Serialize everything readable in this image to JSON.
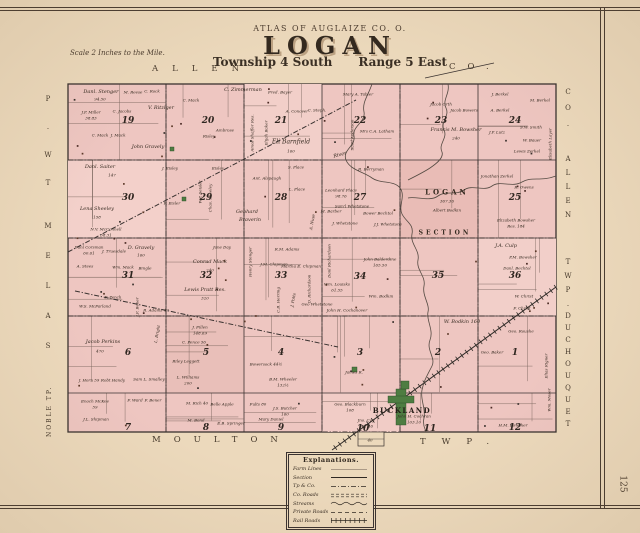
{
  "page": {
    "number": "125"
  },
  "colors": {
    "paper": "#ecd9bc",
    "map_pink": "#eec6c1",
    "village_green": "#4e7d42",
    "ink": "#3a3230"
  },
  "header": {
    "atlas_line": "ATLAS OF AUGLAIZE CO. O.",
    "title": "LOGAN",
    "township": "Township 4 South",
    "range": "Range 5 East",
    "scale_note": "Scale 2 Inches to the Mile."
  },
  "borders": {
    "top_name": "ALLEN",
    "top_suffix": "CO.",
    "right_co": "CO.",
    "right_county": "ALLEN",
    "right_twp": "TWP.",
    "right_township": "DUCHOUQUET",
    "left_top_display": "P.WT",
    "left_mid_display": "MELAS",
    "noble": "NOBLE TP.",
    "bottom_name": "MOULTON",
    "bottom_suffix": "TWP."
  },
  "village": {
    "name": "BUCKLAND"
  },
  "legend": {
    "title": "Explanations.",
    "rows": [
      {
        "label": "Farm Lines",
        "style": "thin"
      },
      {
        "label": "Section",
        "style": "solid"
      },
      {
        "label": "Tp & Co.",
        "style": "dashdot"
      },
      {
        "label": "Co. Roads",
        "style": "double"
      },
      {
        "label": "Streams",
        "style": "wavy"
      },
      {
        "label": "Private Roads",
        "style": "dashed"
      },
      {
        "label": "Rail Roads",
        "style": "rail"
      }
    ]
  },
  "section_numbers": [
    {
      "n": "19",
      "x": 128,
      "y": 121
    },
    {
      "n": "20",
      "x": 208,
      "y": 121
    },
    {
      "n": "21",
      "x": 281,
      "y": 121
    },
    {
      "n": "22",
      "x": 360,
      "y": 121
    },
    {
      "n": "23",
      "x": 441,
      "y": 121
    },
    {
      "n": "24",
      "x": 515,
      "y": 121
    },
    {
      "n": "30",
      "x": 128,
      "y": 198
    },
    {
      "n": "29",
      "x": 206,
      "y": 198
    },
    {
      "n": "28",
      "x": 281,
      "y": 198
    },
    {
      "n": "27",
      "x": 360,
      "y": 198
    },
    {
      "n": "25",
      "x": 515,
      "y": 198
    },
    {
      "n": "31",
      "x": 128,
      "y": 276
    },
    {
      "n": "32",
      "x": 206,
      "y": 276
    },
    {
      "n": "33",
      "x": 281,
      "y": 276
    },
    {
      "n": "34",
      "x": 360,
      "y": 277
    },
    {
      "n": "35",
      "x": 438,
      "y": 276
    },
    {
      "n": "36",
      "x": 515,
      "y": 276
    },
    {
      "n": "6",
      "x": 128,
      "y": 353
    },
    {
      "n": "5",
      "x": 206,
      "y": 353
    },
    {
      "n": "4",
      "x": 281,
      "y": 353
    },
    {
      "n": "3",
      "x": 360,
      "y": 353
    },
    {
      "n": "2",
      "x": 438,
      "y": 353
    },
    {
      "n": "1",
      "x": 515,
      "y": 353
    },
    {
      "n": "7",
      "x": 128,
      "y": 428
    },
    {
      "n": "8",
      "x": 206,
      "y": 428
    },
    {
      "n": "9",
      "x": 281,
      "y": 428
    },
    {
      "n": "10",
      "x": 363,
      "y": 429
    },
    {
      "n": "11",
      "x": 430,
      "y": 429
    },
    {
      "n": "12",
      "x": 515,
      "y": 428
    }
  ],
  "map_labels": [
    {
      "t": "Danl. Stenger",
      "x": 101,
      "y": 92
    },
    {
      "t": "94.50",
      "x": 100,
      "y": 99,
      "s": 4
    },
    {
      "t": "M. Reese",
      "x": 133,
      "y": 92,
      "s": 4
    },
    {
      "t": "C. Rock",
      "x": 152,
      "y": 91,
      "s": 4
    },
    {
      "t": "C. Zimmerman",
      "x": 243,
      "y": 90
    },
    {
      "t": "Fred. Bayer",
      "x": 280,
      "y": 92,
      "s": 4
    },
    {
      "t": "Mary A. Tabler",
      "x": 358,
      "y": 94,
      "s": 4
    },
    {
      "t": "Jacob Orth",
      "x": 441,
      "y": 104,
      "s": 4
    },
    {
      "t": "Jacob Bowers",
      "x": 464,
      "y": 110,
      "s": 4
    },
    {
      "t": "J. Berkel",
      "x": 500,
      "y": 94,
      "s": 4
    },
    {
      "t": "A. Berkel",
      "x": 500,
      "y": 110,
      "s": 4
    },
    {
      "t": "M. Berkel",
      "x": 540,
      "y": 100,
      "s": 4
    },
    {
      "t": "J.P. Miller",
      "x": 91,
      "y": 112,
      "s": 4
    },
    {
      "t": "38.83",
      "x": 91,
      "y": 118,
      "s": 4
    },
    {
      "t": "C. Jacobs",
      "x": 122,
      "y": 111,
      "s": 4
    },
    {
      "t": "C. Mack",
      "x": 191,
      "y": 100,
      "s": 4
    },
    {
      "t": "V. Ritziger",
      "x": 161,
      "y": 108
    },
    {
      "t": "C. Mack",
      "x": 100,
      "y": 135,
      "s": 4
    },
    {
      "t": "J. Mack",
      "x": 118,
      "y": 135,
      "s": 4
    },
    {
      "t": "John Gravely",
      "x": 148,
      "y": 147
    },
    {
      "t": "Ambrose",
      "x": 225,
      "y": 130,
      "s": 4
    },
    {
      "t": "Risley",
      "x": 209,
      "y": 136,
      "s": 4
    },
    {
      "t": "Amos Shaffer Res.",
      "x": 252,
      "y": 133,
      "r": -90,
      "s": 4
    },
    {
      "t": "Elijah Baker",
      "x": 266,
      "y": 133,
      "r": -90,
      "s": 4
    },
    {
      "t": "A. Conover",
      "x": 297,
      "y": 111,
      "s": 4
    },
    {
      "t": "C. Steph.",
      "x": 317,
      "y": 110,
      "s": 4
    },
    {
      "t": "Eli Barnfield",
      "x": 291,
      "y": 142,
      "s": 6
    },
    {
      "t": "160",
      "x": 291,
      "y": 151,
      "s": 4
    },
    {
      "t": "Saml Anderson",
      "x": 352,
      "y": 135,
      "r": -90,
      "s": 4
    },
    {
      "t": "Mrs C.A. Latham",
      "x": 377,
      "y": 131,
      "s": 4
    },
    {
      "t": "Francis M. Bowsher",
      "x": 456,
      "y": 130
    },
    {
      "t": "240",
      "x": 456,
      "y": 138,
      "s": 4
    },
    {
      "t": "J.P. Lutz",
      "x": 497,
      "y": 132,
      "s": 4
    },
    {
      "t": "S.W. Smith",
      "x": 531,
      "y": 127,
      "s": 4
    },
    {
      "t": "W. Bauer",
      "x": 532,
      "y": 140,
      "s": 4
    },
    {
      "t": "Lewis Zerkel",
      "x": 527,
      "y": 151,
      "s": 4
    },
    {
      "t": "Elisabeth Layer",
      "x": 550,
      "y": 144,
      "r": -90,
      "s": 4
    },
    {
      "t": "Danl. Saiter",
      "x": 100,
      "y": 167
    },
    {
      "t": "147",
      "x": 112,
      "y": 175,
      "s": 4
    },
    {
      "t": "J. Eisley",
      "x": 170,
      "y": 168,
      "s": 4
    },
    {
      "t": "Eisley",
      "x": 218,
      "y": 168,
      "s": 4
    },
    {
      "t": "F. Eisler",
      "x": 172,
      "y": 203,
      "s": 4
    },
    {
      "t": "W.P. Seisler",
      "x": 200,
      "y": 192,
      "r": -90,
      "s": 4
    },
    {
      "t": "Chas. Sheeley",
      "x": 210,
      "y": 198,
      "r": -90,
      "s": 4
    },
    {
      "t": "Lena Sheeley",
      "x": 97,
      "y": 209
    },
    {
      "t": "158",
      "x": 97,
      "y": 217,
      "s": 4
    },
    {
      "t": "N.V. McConnell",
      "x": 106,
      "y": 229,
      "s": 4
    },
    {
      "t": "58.31",
      "x": 106,
      "y": 235,
      "s": 4
    },
    {
      "t": "S. Place",
      "x": 296,
      "y": 167,
      "s": 4
    },
    {
      "t": "Ant. Alspaugh",
      "x": 267,
      "y": 178,
      "s": 4
    },
    {
      "t": "L. Place",
      "x": 297,
      "y": 189,
      "s": 4
    },
    {
      "t": "Leonhard Place",
      "x": 341,
      "y": 190,
      "s": 4
    },
    {
      "t": "98.76",
      "x": 341,
      "y": 196,
      "s": 4
    },
    {
      "t": "R. Berryman",
      "x": 371,
      "y": 169,
      "s": 4
    },
    {
      "t": "River",
      "x": 340,
      "y": 155,
      "r": -15
    },
    {
      "t": "Jonathan Zerkel",
      "x": 497,
      "y": 176,
      "s": 4
    },
    {
      "t": "R. Owens",
      "x": 524,
      "y": 187,
      "s": 4
    },
    {
      "t": "LOGAN",
      "x": 447,
      "y": 192,
      "s": 7,
      "ls": 3,
      "n": 1
    },
    {
      "t": "367.36",
      "x": 447,
      "y": 201,
      "s": 4
    },
    {
      "t": "Albert Bodkin",
      "x": 447,
      "y": 210,
      "s": 4
    },
    {
      "t": "SECTION",
      "x": 445,
      "y": 233,
      "s": 6,
      "ls": 3,
      "n": 1
    },
    {
      "t": "Gebhard",
      "x": 247,
      "y": 212
    },
    {
      "t": "Braverin",
      "x": 250,
      "y": 220
    },
    {
      "t": "A. Nuse",
      "x": 312,
      "y": 222,
      "r": -80,
      "s": 4
    },
    {
      "t": "M. Barber",
      "x": 331,
      "y": 211,
      "s": 4
    },
    {
      "t": "Sam'l Whetstone",
      "x": 352,
      "y": 206,
      "s": 4
    },
    {
      "t": "J. Whetstone",
      "x": 345,
      "y": 223,
      "s": 4
    },
    {
      "t": "J.J. Whetstone",
      "x": 388,
      "y": 224,
      "s": 4
    },
    {
      "t": "Bower Bechtol",
      "x": 378,
      "y": 213,
      "s": 4
    },
    {
      "t": "Elizabeth Bowsher",
      "x": 516,
      "y": 220,
      "s": 4
    },
    {
      "t": "Res. 184",
      "x": 516,
      "y": 226,
      "s": 4
    },
    {
      "t": "J.A. Culp",
      "x": 506,
      "y": 246
    },
    {
      "t": "P.M. Bowsher",
      "x": 523,
      "y": 257,
      "s": 4
    },
    {
      "t": "Danl. Bechtol",
      "x": 517,
      "y": 268,
      "s": 4
    },
    {
      "t": "Henry Stenger",
      "x": 250,
      "y": 262,
      "r": -90,
      "s": 4
    },
    {
      "t": "Danl Corsman",
      "x": 89,
      "y": 247,
      "s": 4
    },
    {
      "t": "60.61",
      "x": 89,
      "y": 253,
      "s": 4
    },
    {
      "t": "J. Truesdale",
      "x": 114,
      "y": 251,
      "s": 4
    },
    {
      "t": "D. Gravely",
      "x": 141,
      "y": 248
    },
    {
      "t": "160",
      "x": 141,
      "y": 255,
      "s": 4
    },
    {
      "t": "Jane Day",
      "x": 222,
      "y": 247,
      "s": 4
    },
    {
      "t": "Conrad Mack",
      "x": 210,
      "y": 262
    },
    {
      "t": "240",
      "x": 210,
      "y": 270,
      "s": 4
    },
    {
      "t": "R.M. Adams",
      "x": 287,
      "y": 249,
      "s": 4
    },
    {
      "t": "J.M. Chipman",
      "x": 274,
      "y": 264,
      "s": 4
    },
    {
      "t": "Martha E. Chipman",
      "x": 301,
      "y": 266,
      "s": 4
    },
    {
      "t": "John Balderdine",
      "x": 380,
      "y": 259,
      "s": 4
    },
    {
      "t": "165.50",
      "x": 380,
      "y": 265,
      "s": 4
    },
    {
      "t": "A. Stees",
      "x": 85,
      "y": 266,
      "s": 4
    },
    {
      "t": "Wm. Mack",
      "x": 123,
      "y": 267,
      "s": 4
    },
    {
      "t": "Bingle",
      "x": 145,
      "y": 268,
      "s": 4
    },
    {
      "t": "W.S. McFarland",
      "x": 95,
      "y": 306,
      "s": 4
    },
    {
      "t": "F. Pench",
      "x": 113,
      "y": 297,
      "s": 4
    },
    {
      "t": "J.F. Bener",
      "x": 137,
      "y": 307,
      "r": -90,
      "s": 4
    },
    {
      "t": "R. Adams 47",
      "x": 156,
      "y": 310,
      "s": 4
    },
    {
      "t": "Lewis Pratt Res.",
      "x": 205,
      "y": 290
    },
    {
      "t": "320",
      "x": 205,
      "y": 298,
      "s": 4
    },
    {
      "t": "C.B. Herring",
      "x": 278,
      "y": 300,
      "r": -90,
      "s": 4
    },
    {
      "t": "J. Potts",
      "x": 293,
      "y": 300,
      "r": -80,
      "s": 4
    },
    {
      "t": "D. Richardson",
      "x": 309,
      "y": 289,
      "r": -90,
      "s": 4
    },
    {
      "t": "Danl Richardson",
      "x": 329,
      "y": 261,
      "r": -90,
      "s": 4
    },
    {
      "t": "Wm. Louisks",
      "x": 337,
      "y": 284,
      "s": 4
    },
    {
      "t": "61.55",
      "x": 337,
      "y": 290,
      "s": 4
    },
    {
      "t": "Wm. Bodkin",
      "x": 381,
      "y": 296,
      "s": 4
    },
    {
      "t": "W. Bodkin 160",
      "x": 462,
      "y": 322
    },
    {
      "t": "Geo Whetstone",
      "x": 317,
      "y": 304,
      "s": 4
    },
    {
      "t": "John H. Cochanover",
      "x": 347,
      "y": 310,
      "s": 4
    },
    {
      "t": "W. Christ",
      "x": 524,
      "y": 296,
      "s": 4
    },
    {
      "t": "F. Christ",
      "x": 522,
      "y": 308,
      "s": 4
    },
    {
      "t": "Geo. Roushe",
      "x": 521,
      "y": 331,
      "s": 4
    },
    {
      "t": "Geo. Baker",
      "x": 492,
      "y": 352,
      "s": 4
    },
    {
      "t": "Elias Rigner",
      "x": 546,
      "y": 366,
      "r": -90,
      "s": 4
    },
    {
      "t": "Wm. Moser",
      "x": 549,
      "y": 400,
      "r": -90,
      "s": 4
    },
    {
      "t": "Jacob Perkins",
      "x": 103,
      "y": 342
    },
    {
      "t": "470",
      "x": 100,
      "y": 351,
      "s": 4
    },
    {
      "t": "J. Fillen",
      "x": 200,
      "y": 327,
      "s": 4
    },
    {
      "t": "148.69",
      "x": 200,
      "y": 333,
      "s": 4
    },
    {
      "t": "C. Pence 56",
      "x": 194,
      "y": 342,
      "s": 4
    },
    {
      "t": "L. Bright",
      "x": 157,
      "y": 334,
      "r": -80,
      "s": 4
    },
    {
      "t": "Riley Leggett",
      "x": 186,
      "y": 361,
      "s": 4
    },
    {
      "t": "L. Williams",
      "x": 188,
      "y": 377,
      "s": 4
    },
    {
      "t": "200",
      "x": 188,
      "y": 383,
      "s": 4
    },
    {
      "t": "J. Horn 59",
      "x": 89,
      "y": 380,
      "s": 4
    },
    {
      "t": "Robt Handy",
      "x": 113,
      "y": 380,
      "s": 4
    },
    {
      "t": "Sam L. Smalley",
      "x": 149,
      "y": 379,
      "s": 4
    },
    {
      "t": "Enoch McKee",
      "x": 95,
      "y": 401,
      "s": 4
    },
    {
      "t": "59",
      "x": 95,
      "y": 407,
      "s": 4
    },
    {
      "t": "F. Ward",
      "x": 135,
      "y": 400,
      "s": 4
    },
    {
      "t": "F. Bener",
      "x": 153,
      "y": 400,
      "s": 4
    },
    {
      "t": "J.L. Shipman",
      "x": 96,
      "y": 419,
      "s": 4
    },
    {
      "t": "M. Rich 40",
      "x": 197,
      "y": 403,
      "s": 4
    },
    {
      "t": "Belle Apple",
      "x": 222,
      "y": 404,
      "s": 4
    },
    {
      "t": "Fults 80",
      "x": 258,
      "y": 404,
      "s": 4
    },
    {
      "t": "J.S. Butcher",
      "x": 285,
      "y": 408,
      "s": 4
    },
    {
      "t": "160",
      "x": 285,
      "y": 414,
      "s": 4
    },
    {
      "t": "B.M. Wheeler",
      "x": 283,
      "y": 379,
      "s": 4
    },
    {
      "t": "132½",
      "x": 283,
      "y": 385,
      "s": 4
    },
    {
      "t": "Bowersock 44½",
      "x": 266,
      "y": 364,
      "s": 4
    },
    {
      "t": "Mary Daniel",
      "x": 271,
      "y": 419,
      "s": 4
    },
    {
      "t": "M. Bond",
      "x": 196,
      "y": 420,
      "s": 4
    },
    {
      "t": "E.B. Springer",
      "x": 231,
      "y": 423,
      "s": 4
    },
    {
      "t": "Geo. Blackburn",
      "x": 350,
      "y": 404,
      "s": 4
    },
    {
      "t": "108",
      "x": 350,
      "y": 410,
      "s": 4
    },
    {
      "t": "Jno. Coy",
      "x": 366,
      "y": 420,
      "s": 4
    },
    {
      "t": "101.46",
      "x": 366,
      "y": 426,
      "s": 4
    },
    {
      "t": "John H. Cochran",
      "x": 414,
      "y": 416,
      "s": 4
    },
    {
      "t": "103.10",
      "x": 414,
      "y": 422,
      "s": 4
    },
    {
      "t": "James R.",
      "x": 354,
      "y": 372,
      "s": 4
    },
    {
      "t": "H.M. Bowsher",
      "x": 513,
      "y": 425,
      "s": 4
    },
    {
      "t": "40",
      "x": 370,
      "y": 440,
      "s": 4
    }
  ]
}
